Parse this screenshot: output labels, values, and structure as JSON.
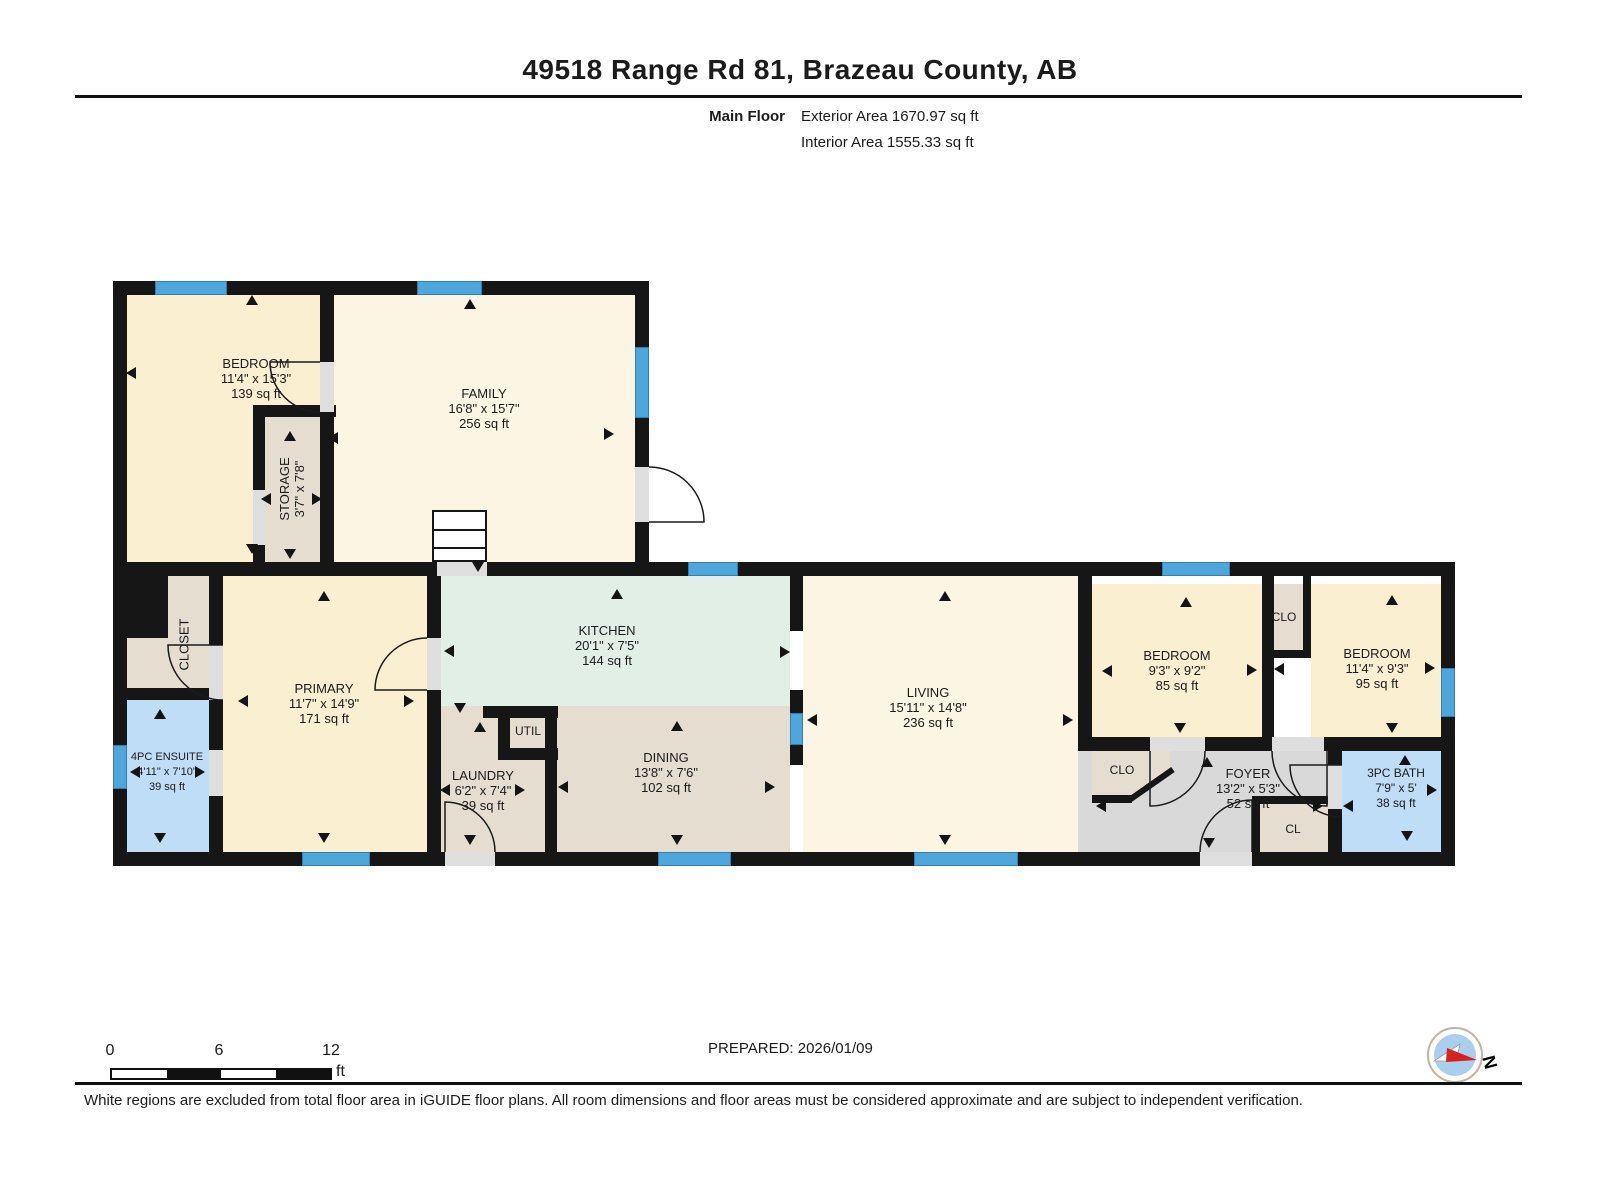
{
  "title": "49518 Range Rd 81, Brazeau County, AB",
  "floor_info": {
    "floor": "Main Floor",
    "exterior": "Exterior Area 1670.97 sq ft",
    "interior": "Interior Area 1555.33 sq ft"
  },
  "prepared": "PREPARED: 2026/01/09",
  "disclaimer": "White regions are excluded from total floor area in iGUIDE floor plans. All room dimensions and floor areas must be considered approximate and are subject to independent verification.",
  "scale_bar": {
    "labels": [
      "0",
      "6",
      "12"
    ],
    "unit": "ft",
    "segments": 4
  },
  "compass": {
    "label": "N"
  },
  "colors": {
    "cream1": "#FBEFD2",
    "cream2": "#FCF5E3",
    "beige": "#E4DDD0",
    "green": "#E2EFE7",
    "blue": "#BFDDF6",
    "grey": "#D9D9D9",
    "wall": "#161616",
    "window": "#4EA6DB",
    "door": "#DEDEDE"
  },
  "floorplan": {
    "fills": [
      {
        "name": "bedroom-tl",
        "c": "cream1",
        "r": [
          127,
          295,
          193,
          267
        ]
      },
      {
        "name": "family",
        "c": "cream2",
        "r": [
          334,
          295,
          301,
          267
        ]
      },
      {
        "name": "storage",
        "c": "beige",
        "r": [
          265,
          417,
          55,
          145
        ]
      },
      {
        "name": "closet",
        "c": "beige",
        "r": [
          127,
          576,
          82,
          112
        ]
      },
      {
        "name": "ensuite",
        "c": "blue",
        "r": [
          127,
          700,
          82,
          152
        ]
      },
      {
        "name": "primary",
        "c": "cream1",
        "r": [
          222,
          576,
          205,
          276
        ]
      },
      {
        "name": "kitchen",
        "c": "green",
        "r": [
          441,
          576,
          349,
          130
        ]
      },
      {
        "name": "laundry",
        "c": "beige",
        "r": [
          441,
          706,
          104,
          146
        ]
      },
      {
        "name": "util",
        "c": "beige",
        "r": [
          510,
          718,
          35,
          30
        ]
      },
      {
        "name": "dining",
        "c": "beige",
        "r": [
          557,
          706,
          233,
          146
        ]
      },
      {
        "name": "living",
        "c": "cream2",
        "r": [
          803,
          576,
          275,
          276
        ]
      },
      {
        "name": "passage",
        "c": "grey",
        "r": [
          1078,
          741,
          20,
          111
        ]
      },
      {
        "name": "foyer",
        "c": "grey",
        "r": [
          1092,
          751,
          236,
          101
        ]
      },
      {
        "name": "bedroom-r1",
        "c": "cream1",
        "r": [
          1092,
          584,
          170,
          153
        ]
      },
      {
        "name": "clo-1",
        "c": "beige",
        "r": [
          1266,
          584,
          37,
          66
        ]
      },
      {
        "name": "bedroom-r2",
        "c": "cream1",
        "r": [
          1311,
          584,
          130,
          153
        ]
      },
      {
        "name": "bath",
        "c": "blue",
        "r": [
          1342,
          751,
          99,
          101
        ]
      },
      {
        "name": "cl",
        "c": "beige",
        "r": [
          1260,
          804,
          68,
          48
        ]
      },
      {
        "name": "clo-2",
        "c": "beige",
        "r": [
          1092,
          751,
          78,
          50
        ],
        "clip": "polygon(0 0,100% 0,100% 40%,55% 100%,0 100%)"
      }
    ],
    "walls": [
      [
        113,
        281,
        535,
        14
      ],
      [
        113,
        281,
        14,
        295
      ],
      [
        635,
        281,
        14,
        295
      ],
      [
        320,
        281,
        14,
        131
      ],
      [
        253,
        405,
        83,
        12
      ],
      [
        253,
        405,
        12,
        171
      ],
      [
        320,
        405,
        14,
        171
      ],
      [
        113,
        562,
        1342,
        14
      ],
      [
        113,
        576,
        14,
        290
      ],
      [
        1441,
        562,
        14,
        304
      ],
      [
        113,
        852,
        1342,
        14
      ],
      [
        113,
        576,
        55,
        62
      ],
      [
        209,
        576,
        14,
        276
      ],
      [
        113,
        688,
        110,
        12
      ],
      [
        427,
        576,
        14,
        276
      ],
      [
        483,
        706,
        15,
        12
      ],
      [
        498,
        706,
        60,
        12
      ],
      [
        498,
        712,
        12,
        44
      ],
      [
        498,
        748,
        60,
        12
      ],
      [
        545,
        706,
        12,
        146
      ],
      [
        790,
        576,
        13,
        55
      ],
      [
        790,
        690,
        13,
        25
      ],
      [
        790,
        745,
        13,
        20
      ],
      [
        1078,
        576,
        14,
        165
      ],
      [
        1078,
        737,
        377,
        14
      ],
      [
        1262,
        576,
        12,
        161
      ],
      [
        1303,
        576,
        8,
        79
      ],
      [
        1262,
        650,
        49,
        8
      ],
      [
        1328,
        751,
        14,
        101
      ],
      [
        1252,
        796,
        80,
        8
      ],
      [
        1252,
        796,
        8,
        56
      ],
      [
        1092,
        795,
        40,
        8
      ]
    ],
    "diag_walls": [
      [
        1127,
        798,
        54,
        -35
      ]
    ],
    "windows": [
      [
        155,
        281,
        72,
        14
      ],
      [
        417,
        281,
        65,
        14
      ],
      [
        635,
        347,
        14,
        71
      ],
      [
        688,
        562,
        50,
        14
      ],
      [
        1162,
        562,
        68,
        14
      ],
      [
        1441,
        668,
        14,
        49
      ],
      [
        113,
        745,
        14,
        44
      ],
      [
        302,
        852,
        68,
        14
      ],
      [
        658,
        852,
        73,
        14
      ],
      [
        914,
        852,
        104,
        14
      ],
      [
        790,
        713,
        13,
        32
      ]
    ],
    "door_gaps": [
      [
        320,
        362,
        14,
        50
      ],
      [
        635,
        467,
        14,
        55
      ],
      [
        437,
        562,
        50,
        14
      ],
      [
        209,
        645,
        14,
        55
      ],
      [
        209,
        750,
        14,
        46
      ],
      [
        427,
        638,
        14,
        52
      ],
      [
        445,
        852,
        50,
        14
      ],
      [
        1150,
        737,
        55,
        14
      ],
      [
        1272,
        737,
        52,
        14
      ],
      [
        1328,
        765,
        14,
        44
      ],
      [
        1200,
        852,
        52,
        14
      ],
      [
        253,
        490,
        12,
        55
      ]
    ],
    "door_arcs": [
      "M320,412 A50,50 0 0 1 270,362 L320,362",
      "M649,467 A55,55 0 0 1 704,522 L649,522",
      "M223,700 A55,55 0 0 1 168,645 L223,645",
      "M427,638 A52,52 0 0 0 375,690 L427,690",
      "M495,852 A50,50 0 0 0 445,802 L445,852",
      "M1200,852 A52,52 0 0 1 1252,800 L1252,852",
      "M1205,751 A55,55 0 0 1 1150,806 L1150,751",
      "M1272,751 A55,55 0 0 0 1327,806 L1327,751",
      "M1342,817 A52,52 0 0 1 1290,765 L1342,765"
    ],
    "stairs": {
      "x": 432,
      "y": 510,
      "w": 55,
      "h": 52
    },
    "arrows": [
      {
        "d": "u",
        "x": 252,
        "y": 300
      },
      {
        "d": "u",
        "x": 470,
        "y": 304
      },
      {
        "d": "u",
        "x": 290,
        "y": 436
      },
      {
        "d": "u",
        "x": 617,
        "y": 594
      },
      {
        "d": "u",
        "x": 945,
        "y": 596
      },
      {
        "d": "u",
        "x": 1186,
        "y": 602
      },
      {
        "d": "u",
        "x": 1392,
        "y": 600
      },
      {
        "d": "u",
        "x": 324,
        "y": 596
      },
      {
        "d": "u",
        "x": 160,
        "y": 714
      },
      {
        "d": "u",
        "x": 1207,
        "y": 762
      },
      {
        "d": "u",
        "x": 1405,
        "y": 760
      },
      {
        "d": "u",
        "x": 677,
        "y": 726
      },
      {
        "d": "u",
        "x": 480,
        "y": 727
      },
      {
        "d": "d",
        "x": 252,
        "y": 549
      },
      {
        "d": "d",
        "x": 290,
        "y": 554
      },
      {
        "d": "d",
        "x": 478,
        "y": 567
      },
      {
        "d": "d",
        "x": 160,
        "y": 838
      },
      {
        "d": "d",
        "x": 324,
        "y": 838
      },
      {
        "d": "d",
        "x": 470,
        "y": 840
      },
      {
        "d": "d",
        "x": 677,
        "y": 840
      },
      {
        "d": "d",
        "x": 945,
        "y": 840
      },
      {
        "d": "d",
        "x": 1180,
        "y": 728
      },
      {
        "d": "d",
        "x": 1392,
        "y": 728
      },
      {
        "d": "d",
        "x": 1209,
        "y": 843
      },
      {
        "d": "d",
        "x": 1407,
        "y": 836
      },
      {
        "d": "d",
        "x": 460,
        "y": 708
      },
      {
        "d": "l",
        "x": 131,
        "y": 373
      },
      {
        "d": "l",
        "x": 333,
        "y": 438
      },
      {
        "d": "l",
        "x": 266,
        "y": 499
      },
      {
        "d": "l",
        "x": 135,
        "y": 772
      },
      {
        "d": "l",
        "x": 243,
        "y": 701
      },
      {
        "d": "l",
        "x": 449,
        "y": 651
      },
      {
        "d": "l",
        "x": 563,
        "y": 787
      },
      {
        "d": "l",
        "x": 812,
        "y": 720
      },
      {
        "d": "l",
        "x": 1107,
        "y": 671
      },
      {
        "d": "l",
        "x": 1279,
        "y": 669
      },
      {
        "d": "l",
        "x": 1101,
        "y": 806
      },
      {
        "d": "l",
        "x": 1348,
        "y": 806
      },
      {
        "d": "l",
        "x": 445,
        "y": 790
      },
      {
        "d": "r",
        "x": 609,
        "y": 434
      },
      {
        "d": "r",
        "x": 317,
        "y": 499
      },
      {
        "d": "r",
        "x": 200,
        "y": 772
      },
      {
        "d": "r",
        "x": 409,
        "y": 701
      },
      {
        "d": "r",
        "x": 785,
        "y": 652
      },
      {
        "d": "r",
        "x": 520,
        "y": 790
      },
      {
        "d": "r",
        "x": 770,
        "y": 787
      },
      {
        "d": "r",
        "x": 1068,
        "y": 720
      },
      {
        "d": "r",
        "x": 1252,
        "y": 670
      },
      {
        "d": "r",
        "x": 1430,
        "y": 668
      },
      {
        "d": "r",
        "x": 1318,
        "y": 806
      },
      {
        "d": "r",
        "x": 1432,
        "y": 790
      }
    ],
    "labels": [
      {
        "name": "bedroom-tl",
        "lines": [
          "BEDROOM",
          "11'4\" x 15'3\"",
          "139 sq ft"
        ],
        "x": 256,
        "y": 378
      },
      {
        "name": "family",
        "lines": [
          "FAMILY",
          "16'8\" x 15'7\"",
          "256 sq ft"
        ],
        "x": 484,
        "y": 408
      },
      {
        "name": "storage",
        "lines": [
          "STORAGE",
          "3'7\" x 7'8\""
        ],
        "x": 292,
        "y": 489,
        "rot": -90
      },
      {
        "name": "closet",
        "lines": [
          "CLOSET"
        ],
        "x": 184,
        "y": 644,
        "rot": -90
      },
      {
        "name": "primary",
        "lines": [
          "PRIMARY",
          "11'7\" x 14'9\"",
          "171 sq ft"
        ],
        "x": 324,
        "y": 703
      },
      {
        "name": "ensuite",
        "lines": [
          "4PC ENSUITE",
          "4'11\" x 7'10\"",
          "39 sq ft"
        ],
        "x": 167,
        "y": 772,
        "size": 11
      },
      {
        "name": "kitchen",
        "lines": [
          "KITCHEN",
          "20'1\" x 7'5\"",
          "144 sq ft"
        ],
        "x": 607,
        "y": 645
      },
      {
        "name": "util",
        "lines": [
          "UTIL"
        ],
        "x": 528,
        "y": 731,
        "size": 12
      },
      {
        "name": "laundry",
        "lines": [
          "LAUNDRY",
          "6'2\" x 7'4\"",
          "39 sq ft"
        ],
        "x": 483,
        "y": 790
      },
      {
        "name": "dining",
        "lines": [
          "DINING",
          "13'8\" x 7'6\"",
          "102 sq ft"
        ],
        "x": 666,
        "y": 772
      },
      {
        "name": "living",
        "lines": [
          "LIVING",
          "15'11\" x 14'8\"",
          "236 sq ft"
        ],
        "x": 928,
        "y": 707
      },
      {
        "name": "bedroom-r1",
        "lines": [
          "BEDROOM",
          "9'3\" x 9'2\"",
          "85 sq ft"
        ],
        "x": 1177,
        "y": 670
      },
      {
        "name": "clo-1",
        "lines": [
          "CLO"
        ],
        "x": 1284,
        "y": 617,
        "size": 12
      },
      {
        "name": "bedroom-r2",
        "lines": [
          "BEDROOM",
          "11'4\" x 9'3\"",
          "95 sq ft"
        ],
        "x": 1377,
        "y": 668
      },
      {
        "name": "clo-2",
        "lines": [
          "CLO"
        ],
        "x": 1122,
        "y": 770,
        "size": 12
      },
      {
        "name": "foyer",
        "lines": [
          "FOYER",
          "13'2\" x 5'3\"",
          "52 sq ft"
        ],
        "x": 1248,
        "y": 788
      },
      {
        "name": "cl",
        "lines": [
          "CL"
        ],
        "x": 1293,
        "y": 829,
        "size": 12
      },
      {
        "name": "bath",
        "lines": [
          "3PC BATH",
          "7'9\" x 5'",
          "38 sq ft"
        ],
        "x": 1396,
        "y": 788,
        "size": 12
      }
    ]
  }
}
